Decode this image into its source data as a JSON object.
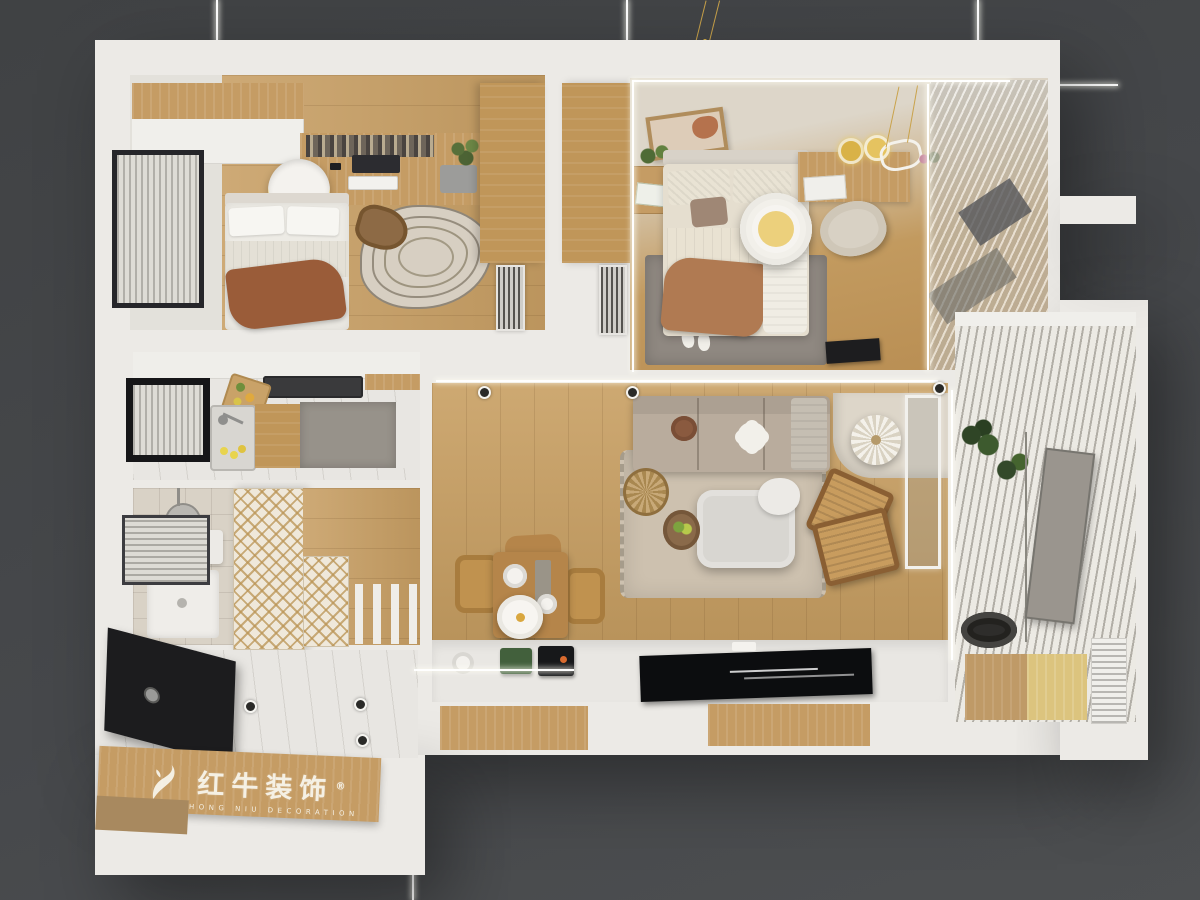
{
  "scene": {
    "description": "Top-down 3D architectural render of a furnished apartment floor plan on a dark grey backdrop",
    "background_color": "#46484b",
    "wall_color": "#eceae6",
    "wood_floor_color": "#c79e63",
    "sofa_color": "#b9ac9d",
    "accent_gold": "#d9b247",
    "black_accent": "#1c1c1e"
  },
  "visible_rooms": [
    "bedroom-study",
    "master-bedroom",
    "kitchen",
    "bathroom",
    "hallway",
    "entry",
    "living-dining-room",
    "balcony"
  ],
  "watermark": {
    "icon": "bull-logo-icon",
    "registered_mark": "®",
    "brand_cn": "红牛装饰",
    "brand_en": "HONG NIU DECORATION"
  }
}
